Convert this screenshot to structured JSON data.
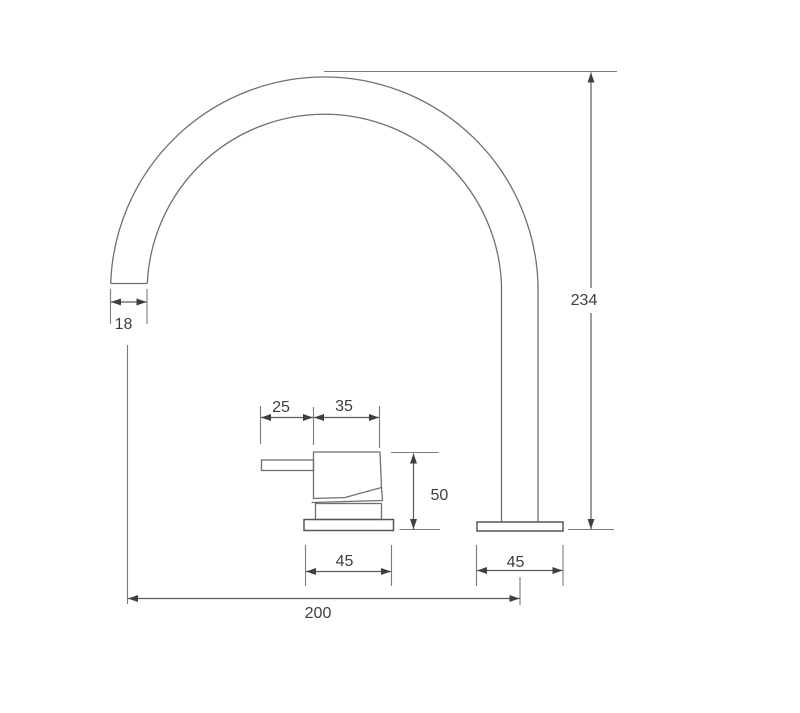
{
  "drawing": {
    "type": "technical-dimension-drawing",
    "subject": "deck-mounted basin mixer tap with gooseneck spout and separate lever handle, side elevation",
    "background_color": "#ffffff",
    "line_color": "#6f6f6f",
    "dimension_line_color": "#5c5c5c",
    "text_color": "#3a3e45",
    "dimensions": {
      "spout_outlet_diameter": {
        "label": "18",
        "meaning": "spout tube diameter at outlet"
      },
      "overall_height": {
        "label": "234",
        "meaning": "height from deck to top of spout arc"
      },
      "lever_length": {
        "label": "25",
        "meaning": "handle lever projection"
      },
      "handle_body_width": {
        "label": "35",
        "meaning": "handle body width"
      },
      "handle_height": {
        "label": "50",
        "meaning": "handle height above deck"
      },
      "handle_base_width": {
        "label": "45",
        "meaning": "handle base flange width"
      },
      "spout_base_width": {
        "label": "45",
        "meaning": "spout base flange width"
      },
      "spout_reach": {
        "label": "200",
        "meaning": "horizontal distance outlet centre to spout riser centre"
      }
    }
  }
}
